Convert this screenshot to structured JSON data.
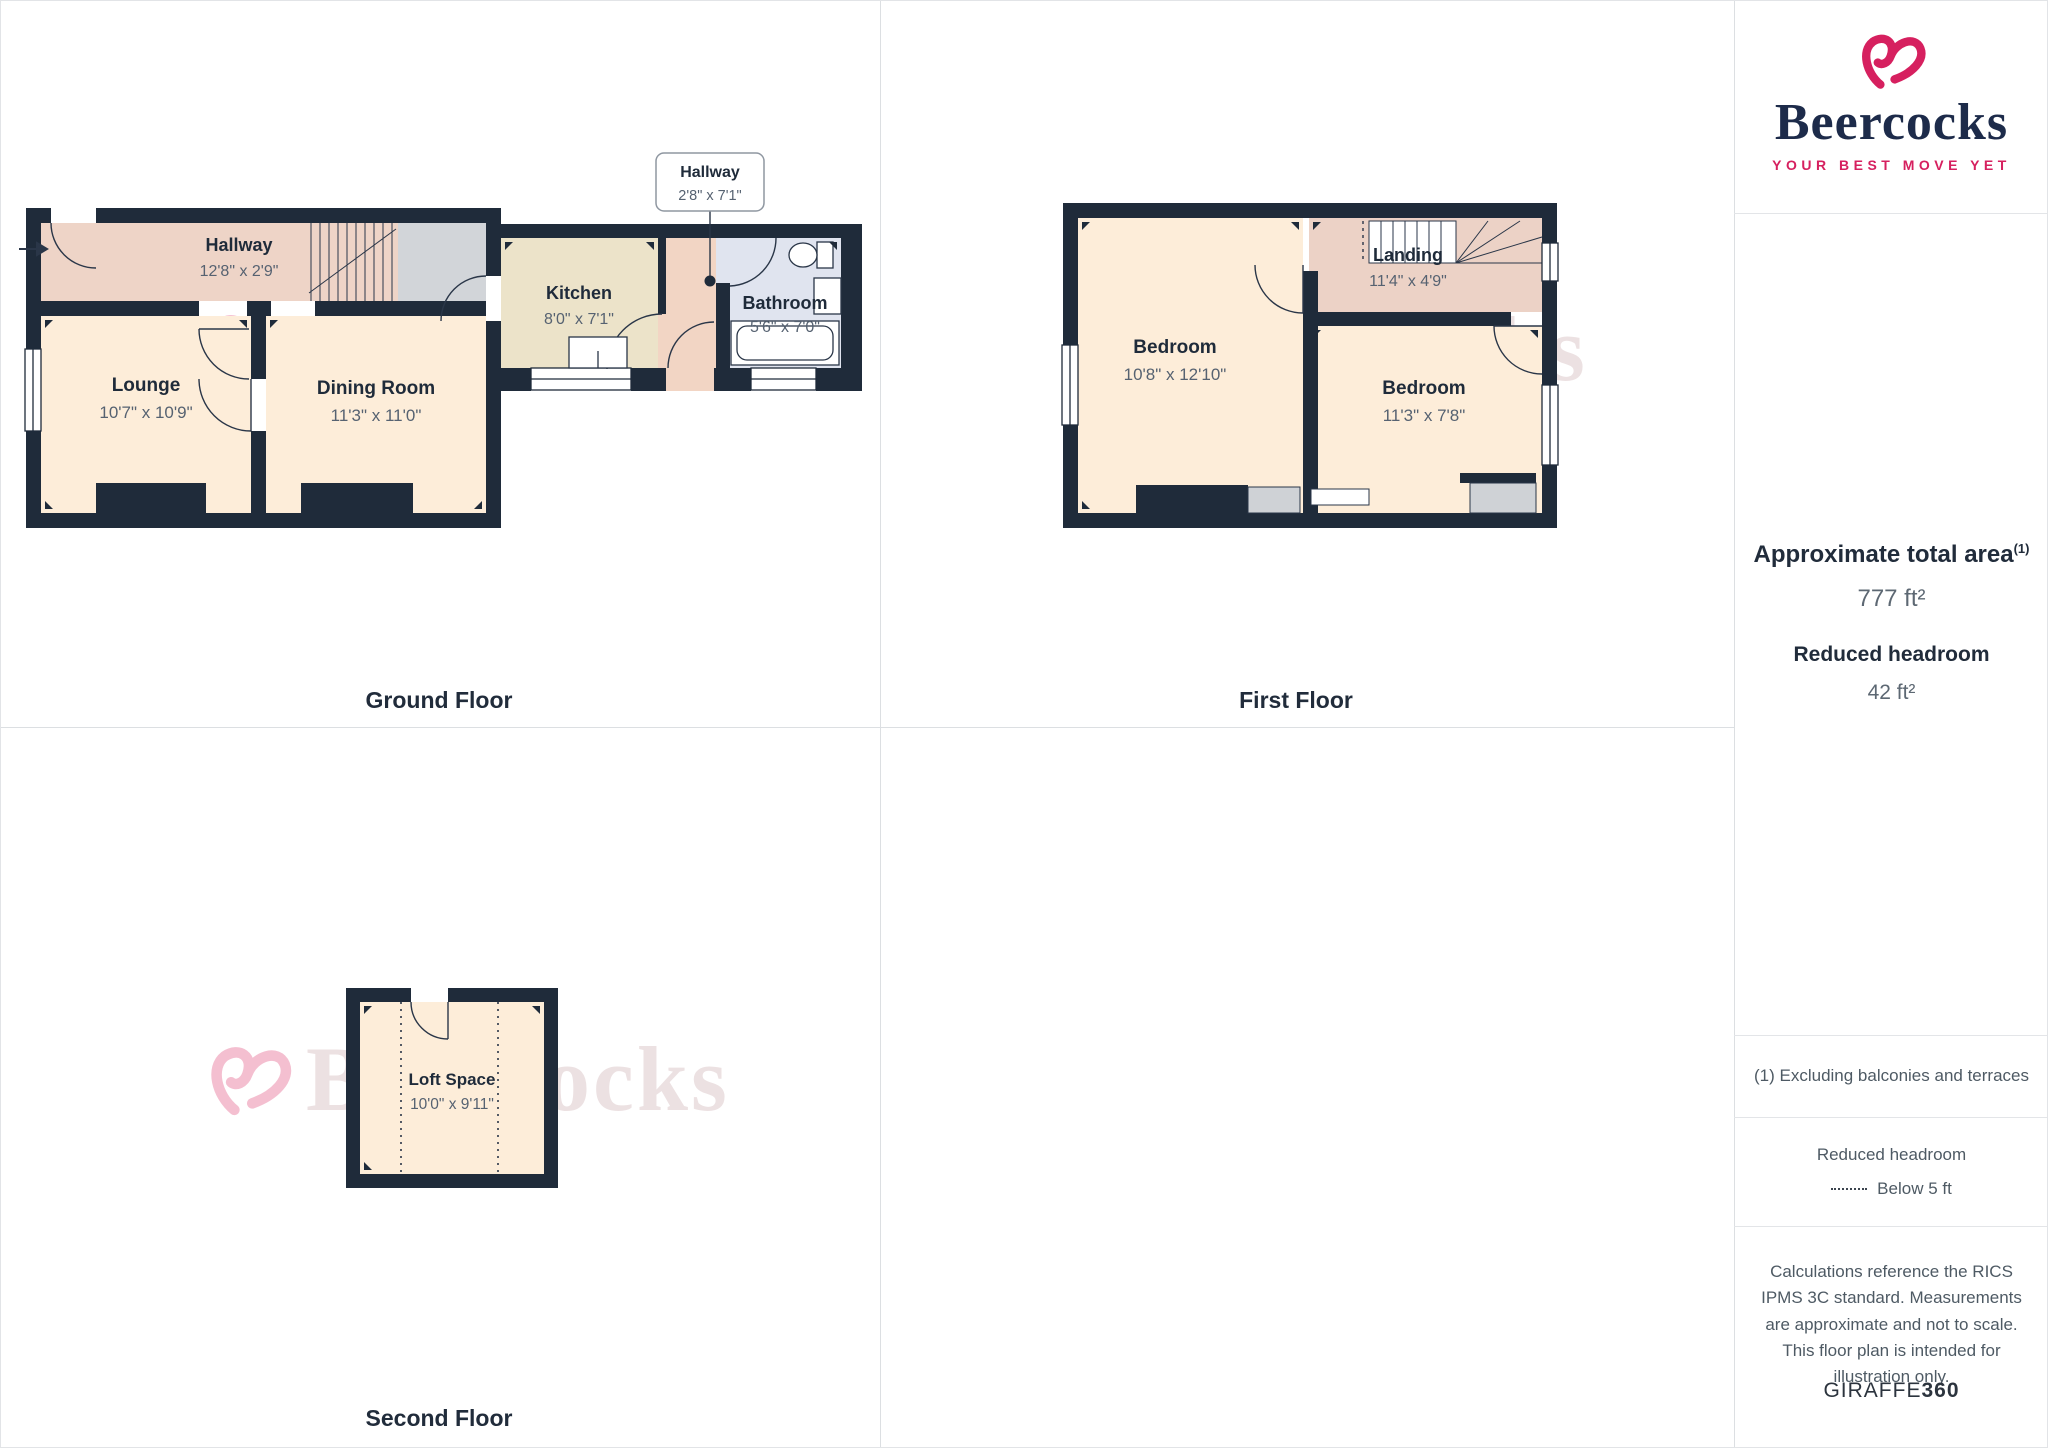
{
  "branding": {
    "name": "Beercocks",
    "tagline": "YOUR BEST MOVE YET",
    "watermark": "Beercocks",
    "pink": "#d6205f",
    "navy": "#1d2b4a"
  },
  "sidebar": {
    "area_heading": "Approximate total area",
    "area_footnote_marker": "(1)",
    "area_value": "777 ft²",
    "headroom_heading": "Reduced headroom",
    "headroom_value": "42 ft²",
    "footnote": "(1) Excluding balconies and terraces",
    "legend_heading": "Reduced headroom",
    "legend_item": "Below 5 ft",
    "disclaimer": "Calculations reference the RICS IPMS 3C standard. Measurements are approximate and not to scale. This floor plan is intended for illustration only.",
    "provider_name": "GIRAFFE",
    "provider_suffix": "360"
  },
  "floors": {
    "ground": {
      "label": "Ground Floor",
      "hallway": {
        "name": "Hallway",
        "dims": "12'8\" x 2'9\""
      },
      "lounge": {
        "name": "Lounge",
        "dims": "10'7\" x 10'9\""
      },
      "dining": {
        "name": "Dining Room",
        "dims": "11'3\" x 11'0\""
      },
      "kitchen": {
        "name": "Kitchen",
        "dims": "8'0\" x 7'1\""
      },
      "hallway2": {
        "name": "Hallway",
        "dims": "2'8\" x 7'1\""
      },
      "bathroom": {
        "name": "Bathroom",
        "dims": "5'6\" x 7'0\""
      }
    },
    "first": {
      "label": "First Floor",
      "bedroom1": {
        "name": "Bedroom",
        "dims": "10'8\" x 12'10\""
      },
      "landing": {
        "name": "Landing",
        "dims": "11'4\" x 4'9\""
      },
      "bedroom2": {
        "name": "Bedroom",
        "dims": "11'3\" x 7'8\""
      }
    },
    "second": {
      "label": "Second Floor",
      "loft": {
        "name": "Loft Space",
        "dims": "10'0\" x 9'11\""
      }
    }
  }
}
